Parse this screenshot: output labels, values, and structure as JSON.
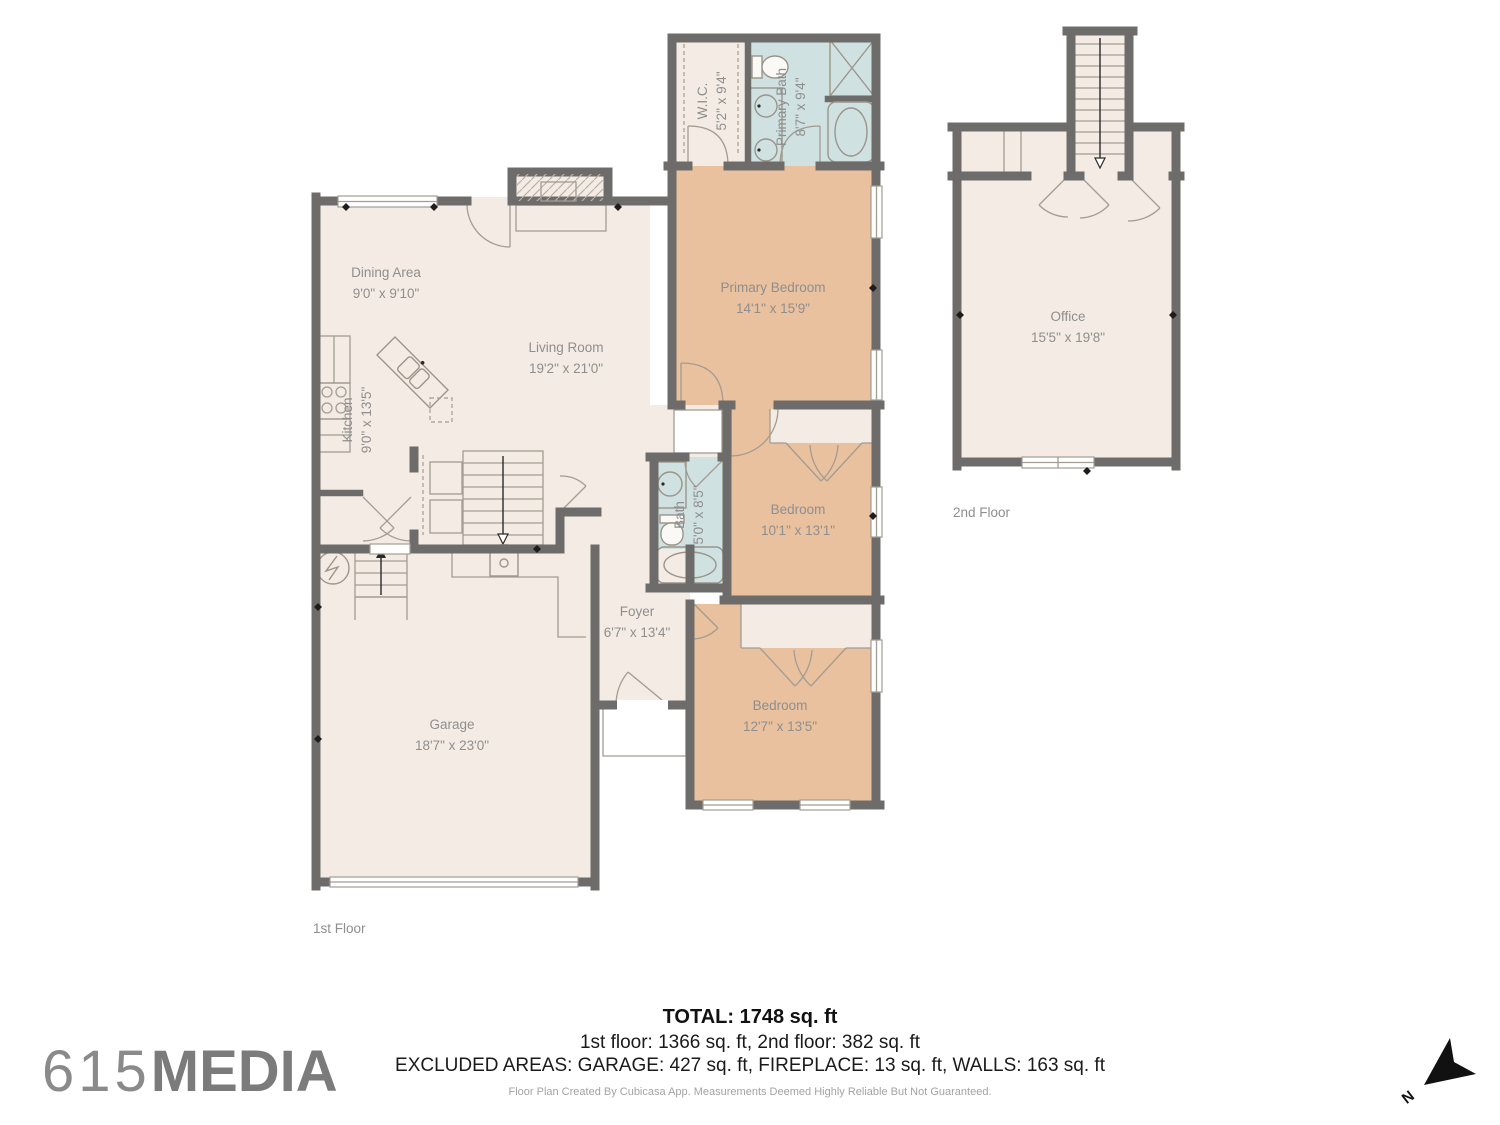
{
  "floors": {
    "first": {
      "label": "1st Floor",
      "rooms": {
        "wic": {
          "name": "W.I.C.",
          "dims": "5'2\" x 9'4\""
        },
        "primary_bath": {
          "name": "Primary Bath",
          "dims": "8'7\" x 9'4\""
        },
        "primary_bedroom": {
          "name": "Primary Bedroom",
          "dims": "14'1\" x 15'9\""
        },
        "dining": {
          "name": "Dining Area",
          "dims": "9'0\" x 9'10\""
        },
        "living": {
          "name": "Living Room",
          "dims": "19'2\" x 21'0\""
        },
        "kitchen": {
          "name": "Kitchen",
          "dims": "9'0\" x 13'5\""
        },
        "bath": {
          "name": "Bath",
          "dims": "5'0\" x 8'5\""
        },
        "bedroom_mid": {
          "name": "Bedroom",
          "dims": "10'1\" x 13'1\""
        },
        "foyer": {
          "name": "Foyer",
          "dims": "6'7\" x 13'4\""
        },
        "bedroom_lower": {
          "name": "Bedroom",
          "dims": "12'7\" x 13'5\""
        },
        "garage": {
          "name": "Garage",
          "dims": "18'7\" x 23'0\""
        }
      }
    },
    "second": {
      "label": "2nd Floor",
      "rooms": {
        "office": {
          "name": "Office",
          "dims": "15'5\" x 19'8\""
        }
      }
    }
  },
  "summary": {
    "total": "TOTAL: 1748 sq. ft",
    "floors_breakdown": "1st floor: 1366 sq. ft, 2nd floor: 382 sq. ft",
    "excluded": "EXCLUDED AREAS: GARAGE: 427 sq. ft, FIREPLACE: 13 sq. ft, WALLS: 163 sq. ft",
    "disclaimer": "Floor Plan Created By Cubicasa App. Measurements Deemed Highly Reliable But Not Guaranteed."
  },
  "branding": {
    "logo_number": "615",
    "logo_word": "MEDIA"
  },
  "compass": {
    "north_label": "N"
  },
  "colors": {
    "wall": "#6d6c6a",
    "floor": "#f4ece4",
    "bedroom": "#e9c19e",
    "wet_room": "#d0e1e1",
    "label_text": "#8e8e8e",
    "summary_text": "#1a1a1a",
    "logo": "#7b7b7b"
  }
}
